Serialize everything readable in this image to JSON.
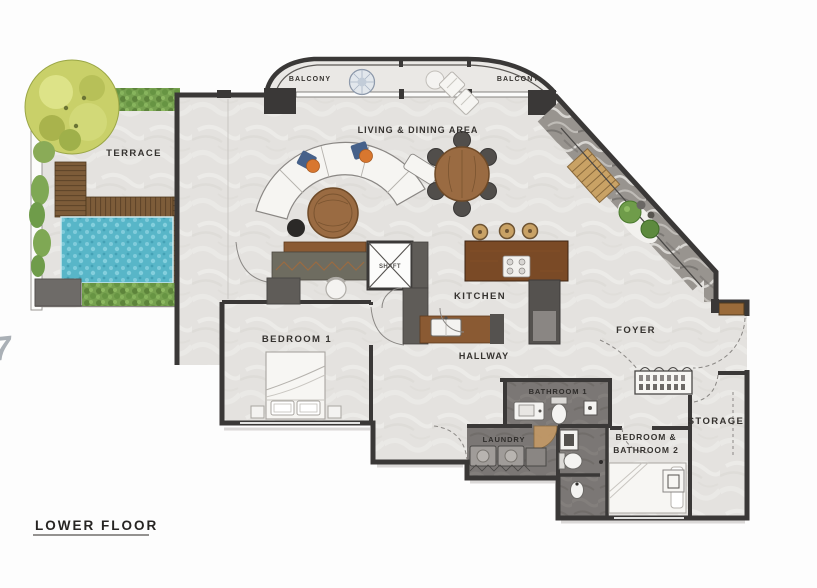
{
  "plan": {
    "title": "LOWER FLOOR",
    "watermark": "7",
    "labels": {
      "balcony_left": "BALCONY",
      "balcony_right": "BALCONY",
      "living_dining": "LIVING & DINING AREA",
      "terrace": "TERRACE",
      "kitchen": "KITCHEN",
      "hallway": "HALLWAY",
      "foyer": "FOYER",
      "bedroom1": "BEDROOM 1",
      "bathroom1": "BATHROOM 1",
      "laundry": "LAUNDRY",
      "bedroom_bathroom2_line1": "BEDROOM &",
      "bedroom_bathroom2_line2": "BATHROOM 2",
      "storage": "STORAGE",
      "shaft": "SHAFT"
    },
    "colors": {
      "wall": "#3a3837",
      "floor": "#e4e2df",
      "floor_dark": "#7b7775",
      "deck": "#7d5c39",
      "deck_stripe": "#5c4228",
      "pool": "#58b6c8",
      "hedge": "#76a14f",
      "tree": "#c9d069",
      "stone": "#98948f",
      "stair_wood": "#c9a265",
      "wood_dark": "#7a4a26",
      "wood_counter": "#8a5a33",
      "accent_orange": "#d8772f",
      "accent_blue": "#46618a"
    }
  }
}
